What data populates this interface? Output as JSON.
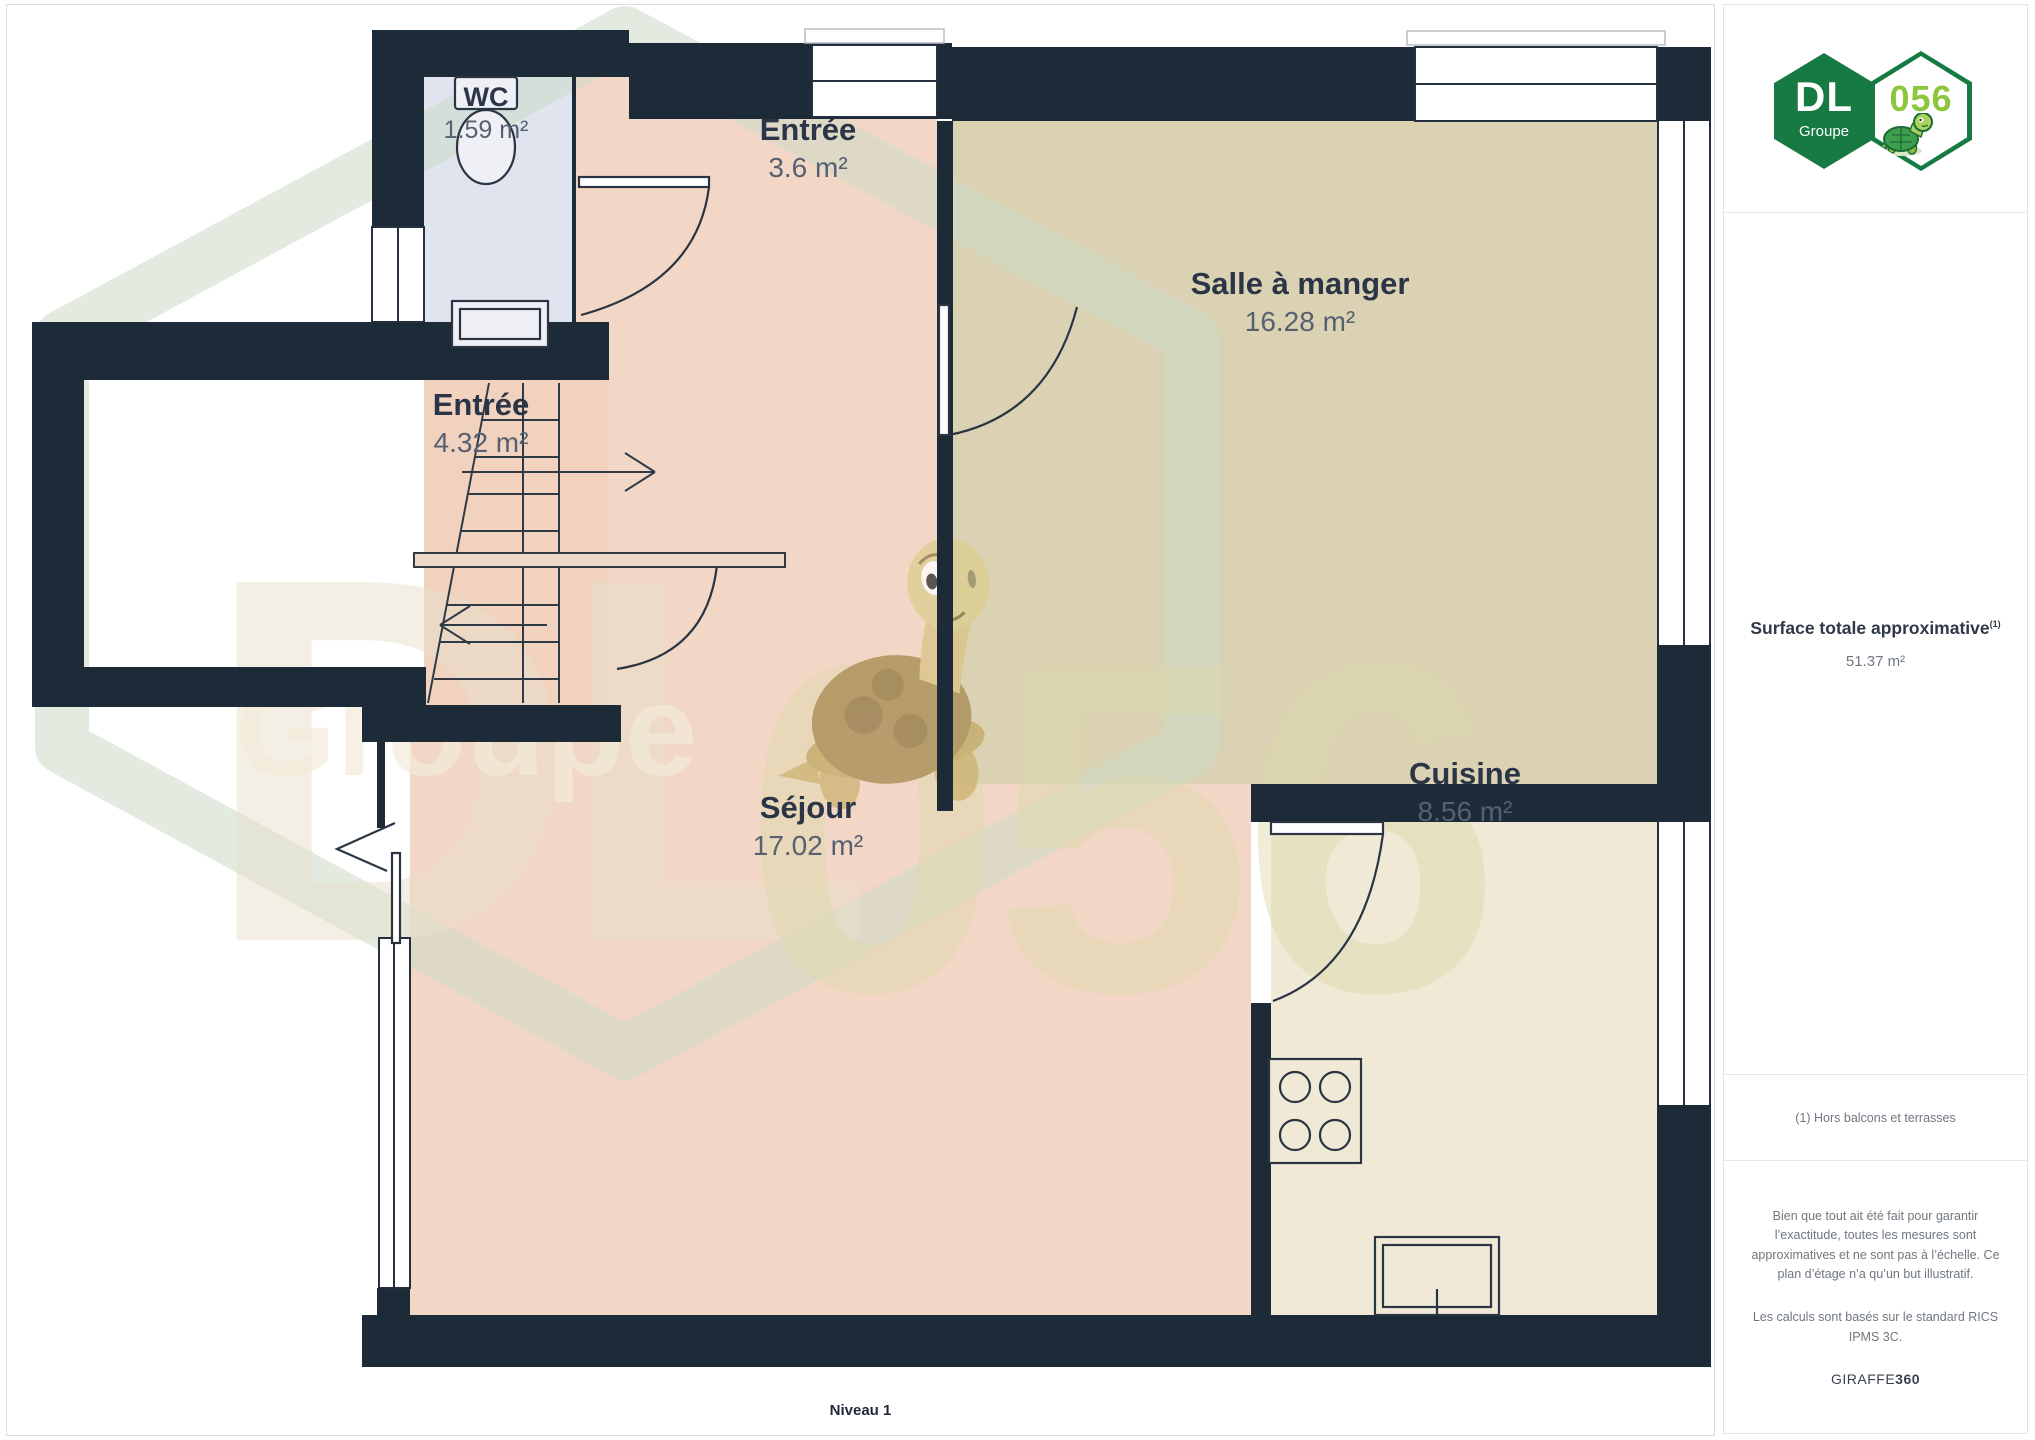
{
  "plan": {
    "level_label": "Niveau 1",
    "rooms": [
      {
        "name": "WC",
        "area": "1.59 m²"
      },
      {
        "name": "Entrée",
        "area": "3.6 m²"
      },
      {
        "name": "Salle à manger",
        "area": "16.28 m²"
      },
      {
        "name": "Entrée",
        "area": "4.32 m²"
      },
      {
        "name": "Séjour",
        "area": "17.02 m²"
      },
      {
        "name": "Cuisine",
        "area": "8.56 m²"
      }
    ],
    "watermark": {
      "dl": "DL",
      "number": "056",
      "groupe": "Groupe"
    }
  },
  "sidebar": {
    "logo": {
      "dl": "DL",
      "groupe": "Groupe",
      "number": "056"
    },
    "surface": {
      "label": "Surface totale approximative",
      "footnote_marker": "(1)",
      "value": "51.37 m²"
    },
    "footnote": "(1) Hors balcons et terrasses",
    "disclaimer": "Bien que tout ait été fait pour garantir l’exactitude, toutes les mesures sont approximatives et ne sont pas à l’échelle. Ce plan d’étage n’a qu’un but illustratif.",
    "standard": "Les calculs sont basés sur le standard RICS IPMS 3C.",
    "brand": {
      "giraffe": "GIRAFFE",
      "threesixty": "360"
    }
  },
  "colors": {
    "wall": "#1d2a38",
    "wc_fill": "#e0e4ef",
    "salmon_fill": "#f3d7c6",
    "dining_fill": "#dbd2b3",
    "kitchen_fill": "#efe9d5",
    "logo_green": "#177a43",
    "logo_lime": "#8cc63e",
    "label_dark": "#2b3547",
    "label_gray": "#566070"
  }
}
